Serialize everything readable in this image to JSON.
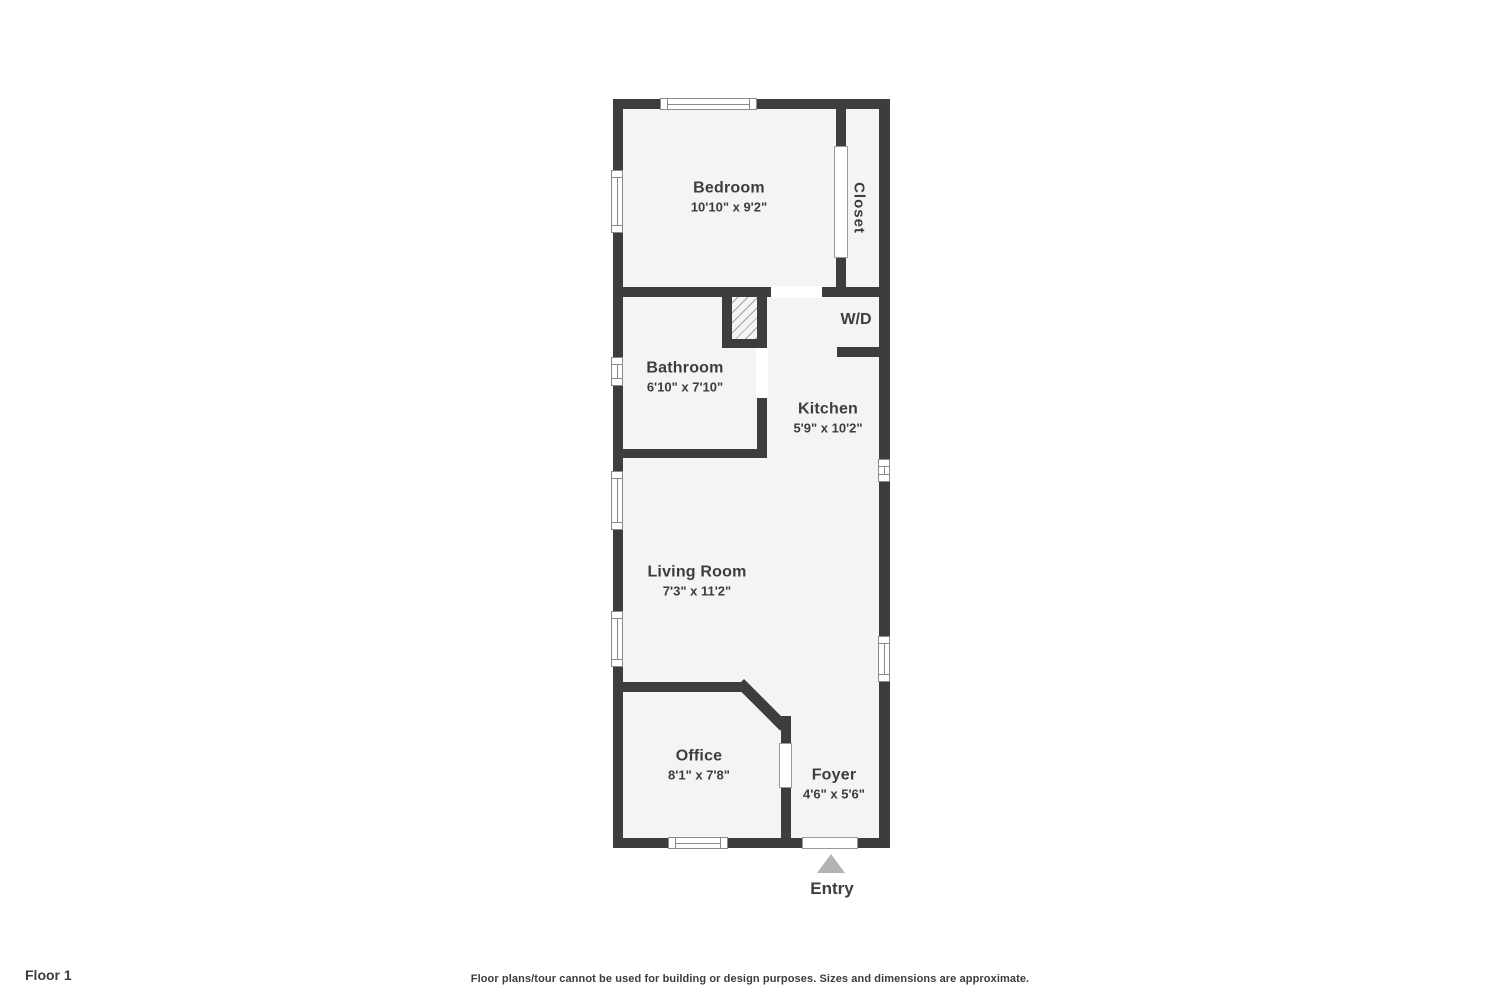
{
  "rooms": {
    "bedroom": {
      "name": "Bedroom",
      "dims": "10'10\" x 9'2\""
    },
    "closet": {
      "name": "Closet"
    },
    "wd": {
      "name": "W/D"
    },
    "bathroom": {
      "name": "Bathroom",
      "dims": "6'10\" x 7'10\""
    },
    "kitchen": {
      "name": "Kitchen",
      "dims": "5'9\" x 10'2\""
    },
    "living_room": {
      "name": "Living Room",
      "dims": "7'3\" x 11'2\""
    },
    "office": {
      "name": "Office",
      "dims": "8'1\" x 7'8\""
    },
    "foyer": {
      "name": "Foyer",
      "dims": "4'6\" x 5'6\""
    }
  },
  "entry_label": "Entry",
  "footer": {
    "floor_label": "Floor 1",
    "disclaimer": "Floor plans/tour cannot be used for building or design purposes. Sizes and dimensions are approximate."
  },
  "icons": {
    "entry_arrow": "triangle-up"
  },
  "colors": {
    "background": "#ffffff",
    "floor": "#f4f4f4",
    "wall": "#3d3d3d",
    "text": "#3d3d3d",
    "window_frame": "#8a8a8a",
    "door_frame": "#9a9a9a",
    "entry_arrow": "#b3b3b3"
  }
}
